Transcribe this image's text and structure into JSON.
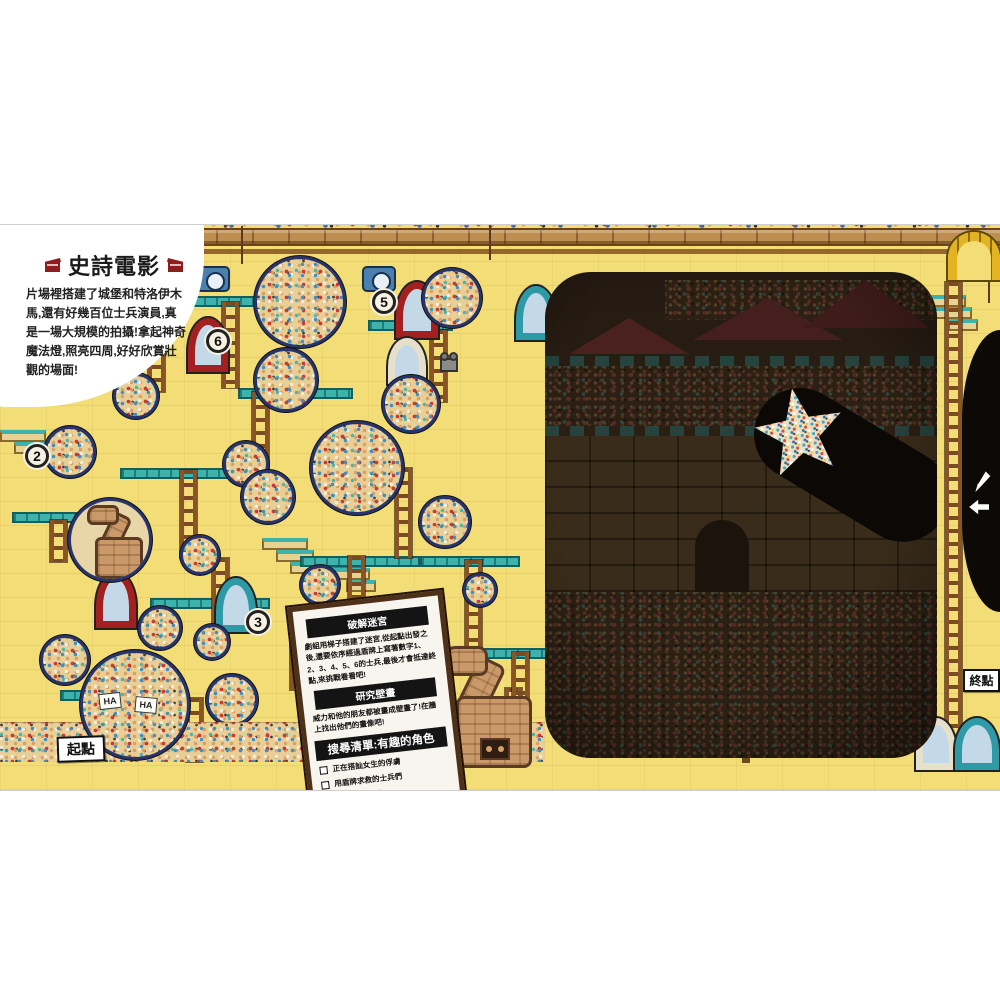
{
  "header": {
    "title": "史詩電影",
    "intro": "片場裡搭建了城堡和特洛伊木馬,還有好幾百位士兵演員,真是一場大規模的拍攝!拿起神奇魔法燈,照亮四周,好好欣賞壯觀的場面!"
  },
  "signs": {
    "start": "起點",
    "end": "終點"
  },
  "panel": {
    "maze": {
      "heading": "破解迷宮",
      "body": "劇組用梯子搭建了迷宮,從起點出發之後,還要依序經過盾牌上寫著數字1、2、3、4、5、6的士兵,最後才會抵達終點,來挑戰看看吧!"
    },
    "mural": {
      "heading": "研究壁畫",
      "body": "威力和他的朋友都被畫成壁畫了!在牆上找出他們的畫像吧!"
    },
    "checklist": {
      "heading": "搜尋清單:有趣的角色",
      "items": [
        "正在搭訕女生的俘虜",
        "用盾牌求救的士兵們",
        "丟垃圾的士兵"
      ]
    }
  },
  "maze_shields": [
    "1",
    "2",
    "3",
    "4",
    "5",
    "6"
  ],
  "laugh_cards": [
    "HA",
    "HA"
  ],
  "colors": {
    "scene_yellow": "#f3dd76",
    "water_teal": "#45b7b3",
    "dark_panel": "#241a12",
    "torch_black": "#0c0906",
    "panel_frame": "#4f3018",
    "accent_red": "#a32020"
  }
}
